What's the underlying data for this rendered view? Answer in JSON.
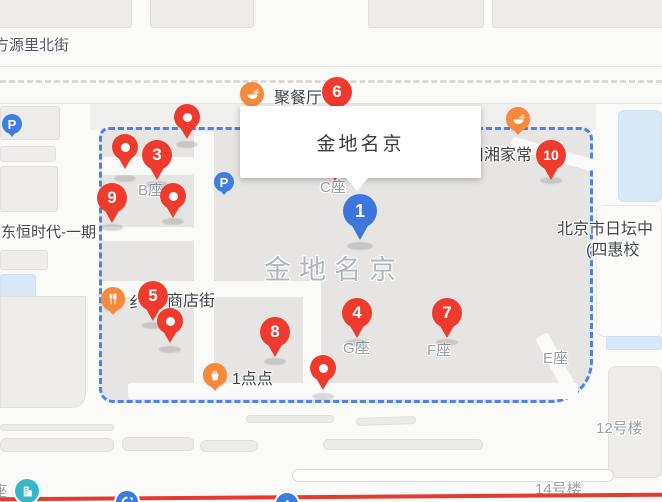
{
  "colors": {
    "pin_red": "#ee3b2d",
    "pin_blue": "#3d76dd",
    "poi_orange": "#f68a3c",
    "boundary_blue": "#4d82e8",
    "road_red": "#e23b30",
    "parking_blue": "#3f7de0",
    "metro_teal": "#36b7c8",
    "metro_blue": "#3a7ce0"
  },
  "info_window": {
    "title": "金地名京"
  },
  "markers": {
    "blue": "1",
    "red": [
      "3",
      "4",
      "5",
      "6",
      "7",
      "8",
      "9",
      "10"
    ]
  },
  "parking": {
    "label": "P"
  },
  "pois": {
    "restaurant_top": "聚餐厅",
    "restaurant_right": "川湘家常",
    "shop_street": "商店街",
    "shop_street_partial": "纟",
    "milk_tea": "1点点"
  },
  "complex": {
    "name": "金地名京",
    "block_b": "B座",
    "block_c": "C座",
    "block_g": "G座",
    "block_f": "F座",
    "block_e": "E座"
  },
  "streets": {
    "fangyuanli_north": "方源里北街",
    "dongheng_phase1": "东恒时代-一期",
    "ritan_line1": "北京市日坛中",
    "ritan_line2": "(四惠校",
    "building_12": "12号楼",
    "building_14": "14号楼",
    "left_edge_partial": "座"
  }
}
